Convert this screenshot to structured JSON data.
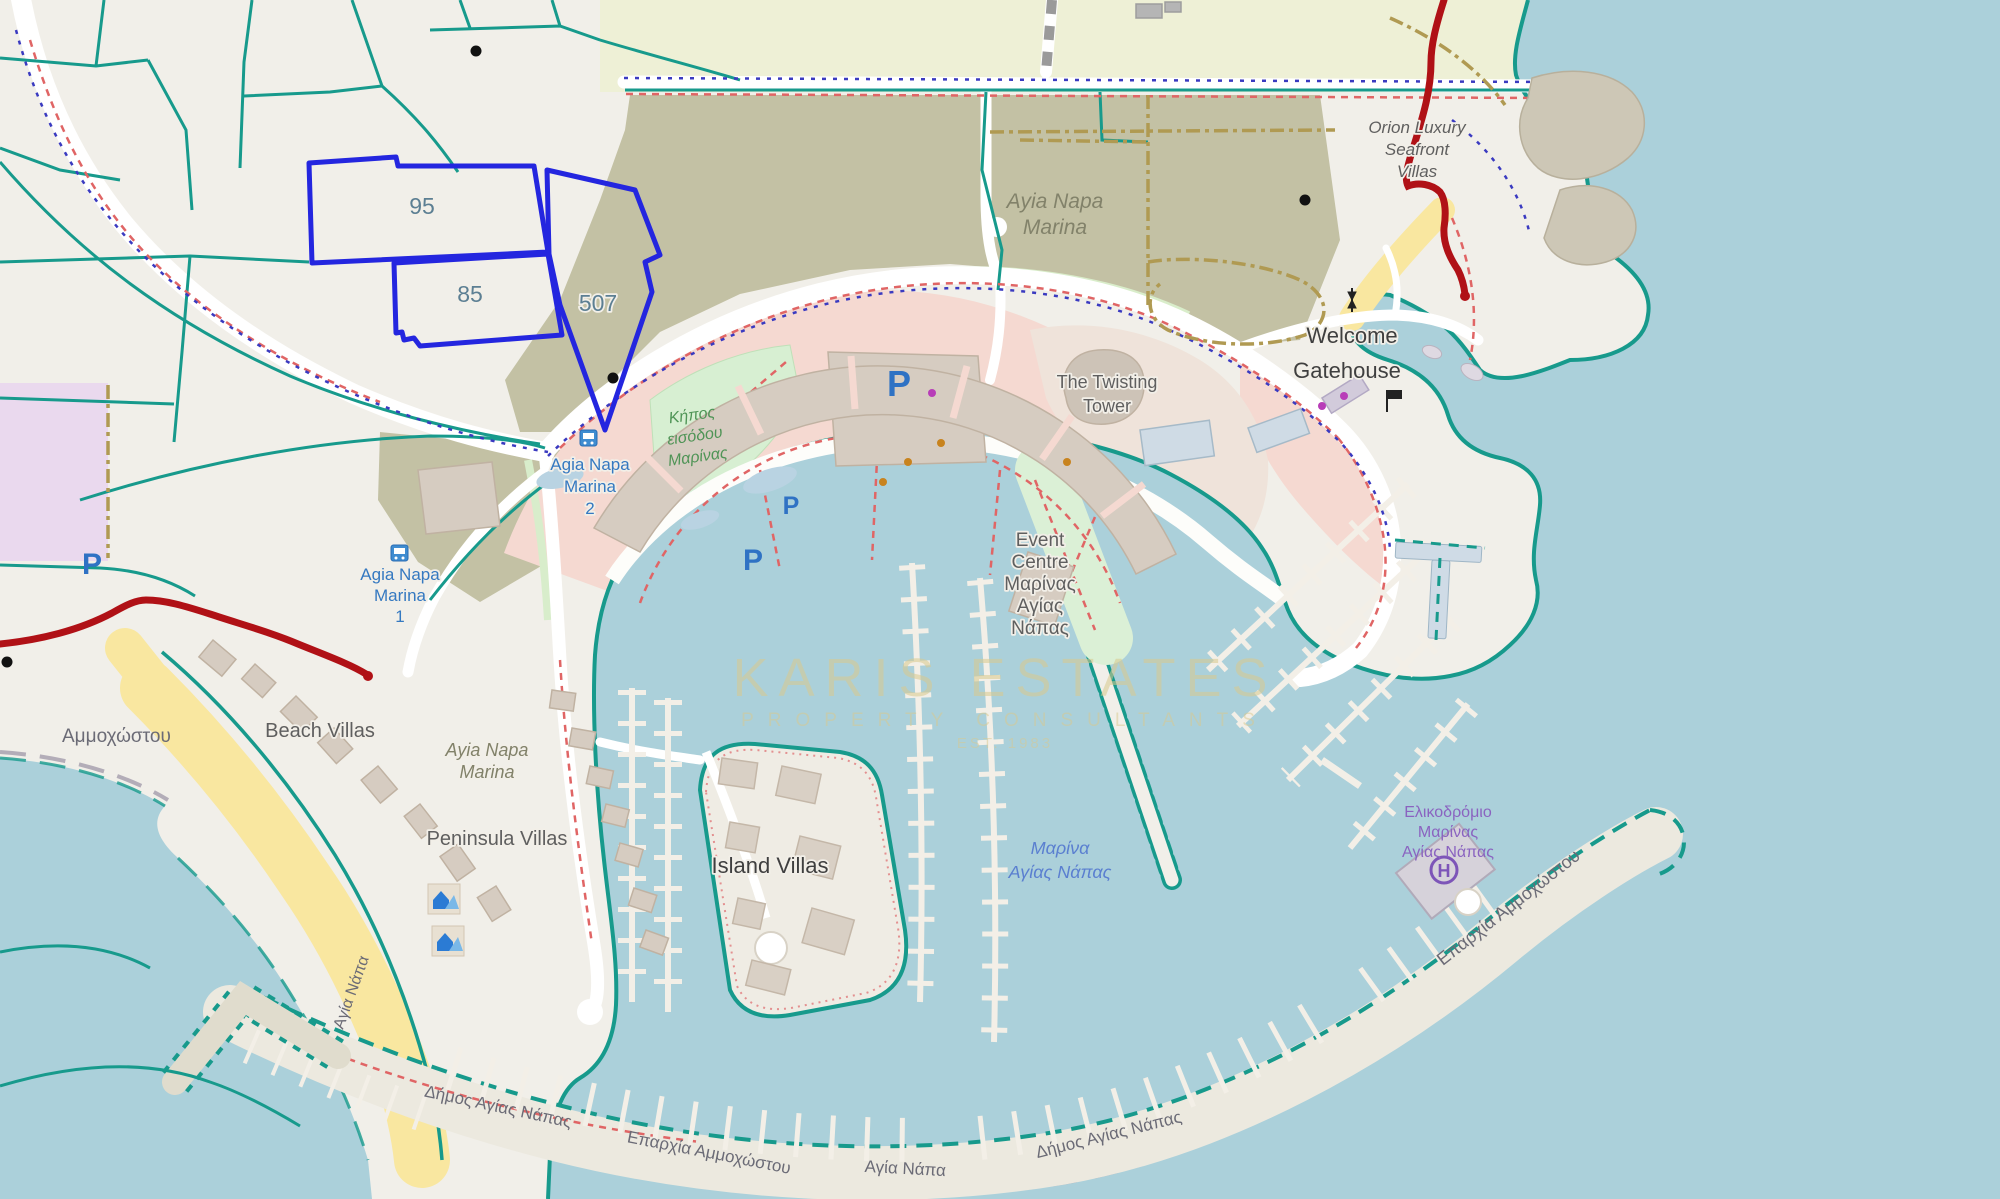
{
  "map": {
    "parcels": {
      "p95": "95",
      "p85": "85",
      "p507": "507"
    },
    "poi": {
      "bus_stop_2": {
        "l1": "Agia Napa",
        "l2": "Marina",
        "l3": "2"
      },
      "bus_stop_1": {
        "l1": "Agia Napa",
        "l2": "Marina",
        "l3": "1"
      },
      "garden": {
        "l1": "Κήπος",
        "l2": "εισόδου",
        "l3": "Μαρίνας"
      },
      "marina_area_top": {
        "l1": "Ayia Napa",
        "l2": "Marina"
      },
      "twisting_tower": {
        "l1": "The Twisting",
        "l2": "Tower"
      },
      "gatehouse": {
        "l1": "Welcome",
        "l2": "Gatehouse"
      },
      "orion": {
        "l1": "Orion Luxury",
        "l2": "Seafront",
        "l3": "Villas"
      },
      "event_centre": {
        "l1": "Event",
        "l2": "Centre",
        "l3": "Μαρίνας",
        "l4": "Αγίας",
        "l5": "Νάπας"
      },
      "beach_villas": "Beach Villas",
      "marina_area_mid": {
        "l1": "Ayia Napa",
        "l2": "Marina"
      },
      "peninsula_villas": "Peninsula Villas",
      "island_villas": "Island Villas",
      "marina_water": {
        "l1": "Μαρίνα",
        "l2": "Αγίας Νάπας"
      },
      "heliport": {
        "l1": "Ελικοδρόμιο",
        "l2": "Μαρίνας",
        "l3": "Αγίας Νάπας"
      },
      "parking": "P",
      "helipad_h": "H"
    },
    "admin": {
      "eparchia_ne": "Επαρχία Αμμοχώστου",
      "eparchia_s": "Επαρχία Αμμοχώστου",
      "agia_napa_s": "Αγία Νάπα",
      "agia_napa_beach": "Αγία Νάπα",
      "dimos_sw": "Δήμος Αγίας Νάπας",
      "dimos_se": "Δήμος Αγίας Νάπας",
      "ammochostou": "Αμμοχώστου"
    },
    "watermark": {
      "line1": "KARIS ESTATES",
      "line2": "PROPERTY CONSULTANTS",
      "line3": "EST. 1983"
    },
    "colors": {
      "water": "#abd0da",
      "land": "#f1efe9",
      "farmland": "#eef0d6",
      "scrub": "#c3c1a4",
      "pedestrian_pink": "#f5d9d1",
      "building": "#d6ccc1",
      "beach": "#f9e7a0",
      "park": "#d7efd2",
      "retail_purple": "#ead9ee",
      "boundary_teal": "#179a8c",
      "parcel_blue": "#2426df",
      "closed_road_red": "#b01116",
      "path_red": "#e06565",
      "route_blue": "#3a3ac0",
      "track_khaki": "#b09a52",
      "watermark_gold": "#d9c98e",
      "poi_blue": "#3579c1",
      "water_label_blue": "#5a7fd0",
      "heliport_purple": "#8a63c0"
    }
  }
}
